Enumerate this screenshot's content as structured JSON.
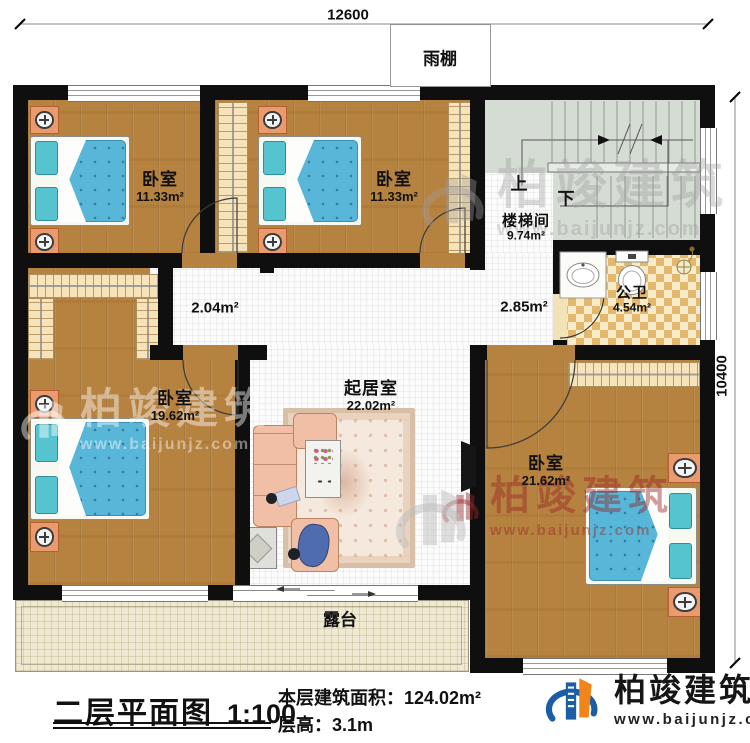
{
  "dimensions": {
    "top": "12600",
    "right": "10400"
  },
  "canopy": {
    "label": "雨棚"
  },
  "terrace": {
    "label": "露台"
  },
  "rooms": {
    "bedroom_nw": {
      "name": "卧室",
      "area": "11.33m²"
    },
    "bedroom_n": {
      "name": "卧室",
      "area": "11.33m²"
    },
    "stairwell": {
      "name": "楼梯间",
      "area": "9.74m²",
      "up": "上",
      "down": "下"
    },
    "bathroom": {
      "name": "公卫",
      "area": "4.54m²"
    },
    "bedroom_w": {
      "name": "卧室",
      "area": "19.62m²"
    },
    "living": {
      "name": "起居室",
      "area": "22.02m²"
    },
    "bedroom_se": {
      "name": "卧室",
      "area": "21.62m²"
    },
    "hall_west": {
      "area": "2.04m²"
    },
    "hall_east": {
      "area": "2.85m²"
    }
  },
  "titleblock": {
    "title": "二层平面图",
    "scale": "1:100",
    "area_label": "本层建筑面积：",
    "area_value": "124.02m²",
    "height_label": "层高：",
    "height_value": "3.1m"
  },
  "branding": {
    "company": "柏竣建筑",
    "website": "www.baijunjz.com"
  },
  "colors": {
    "wall": "#0f0f0f",
    "wood_floor": "#b6823f",
    "stair_floor": "#d5dcd3",
    "bath_tile": "#e3b76c",
    "terrace_floor": "#efe9d4",
    "bed_blue": "#58b7d8",
    "brand_blue": "#1b5ea6",
    "brand_orange": "#f08519",
    "watermark_red": "#96312c"
  }
}
